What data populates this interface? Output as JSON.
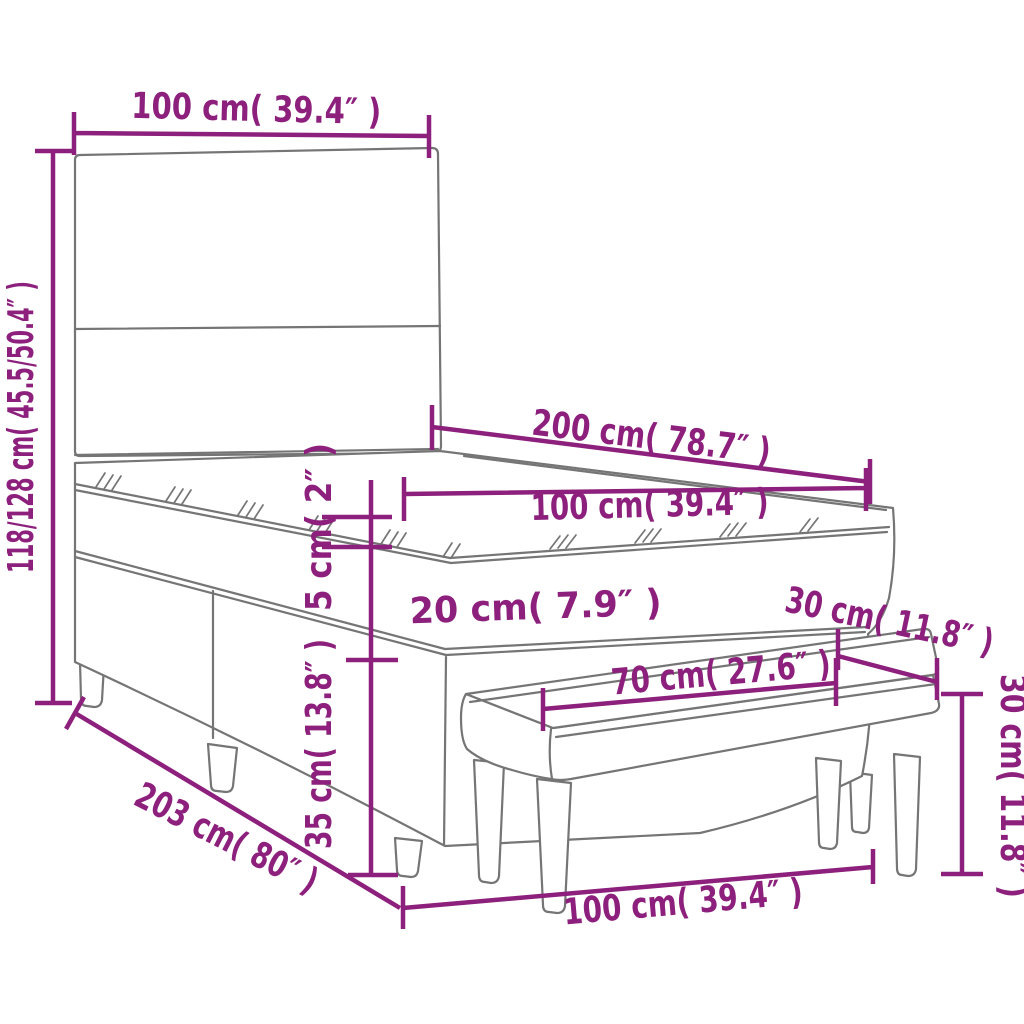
{
  "diagram": {
    "kind": "product-dimension-diagram",
    "subject": "box spring bed with headboard, mattress topper and bench",
    "labels": {
      "headboard_width_top": "100 cm( 39.4″ )",
      "total_height_left": "118/128 cm( 45.5/50.4″ )",
      "mattress_length": "200 cm( 78.7″ )",
      "mattress_width": "100 cm( 39.4″ )",
      "topper_height": "5 cm( 2″ )",
      "mattress_height": "20 cm( 7.9″ )",
      "bench_depth": "30 cm( 11.8″ )",
      "bench_top_width": "70 cm( 27.6″ )",
      "bench_height_right": "30 cm( 11.8″ )",
      "base_height": "35 cm( 13.8″ )",
      "bed_base_length": "203 cm( 80″ )",
      "bench_length_bottom": "100 cm( 39.4″ )"
    },
    "colors": {
      "dimension": "#8C207C",
      "outline": "#757575"
    }
  }
}
